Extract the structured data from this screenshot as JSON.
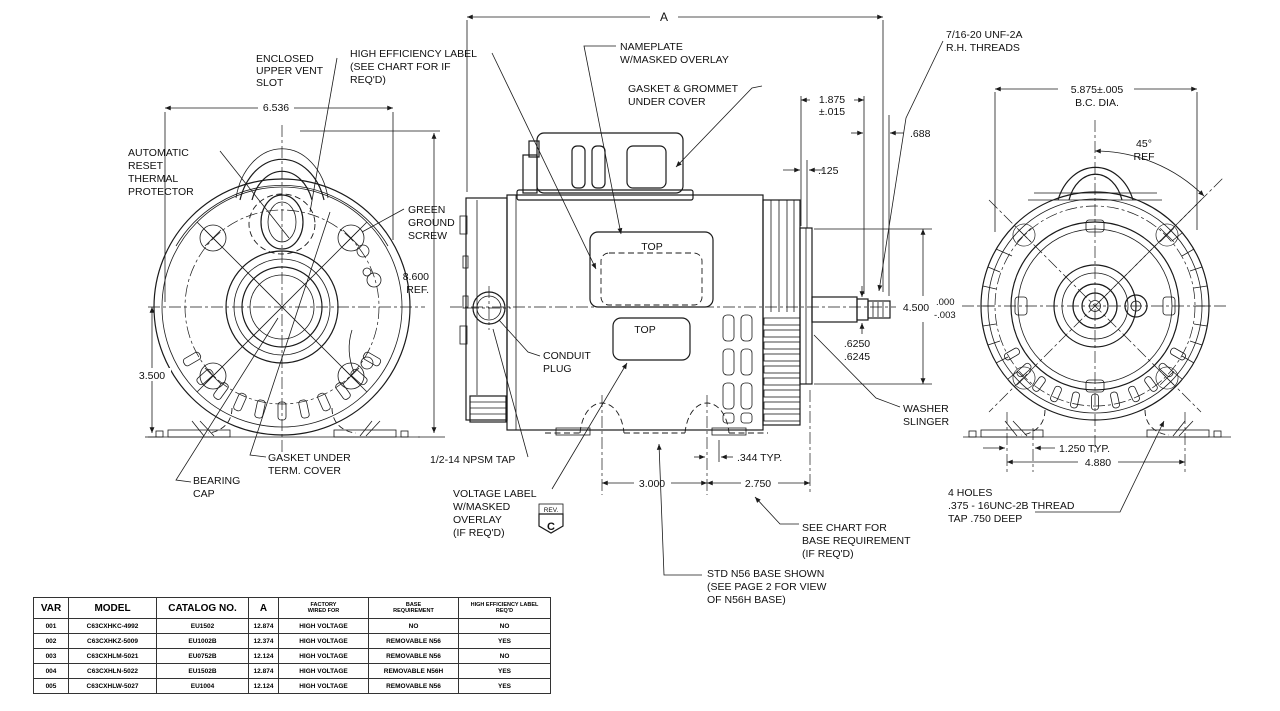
{
  "drawing": {
    "dim_a": "A",
    "d6536": "6.536",
    "d3500": "3.500",
    "d8600": {
      "l1": "8.600",
      "l2": "REF."
    },
    "d1875": {
      "l1": "1.875",
      "l2": "±.015"
    },
    "d688": ".688",
    "d125": ".125",
    "d4500": "4.500",
    "d4500_tol_plus": ".000",
    "d4500_tol_minus": "-.003",
    "shaft_dia": {
      "l1": ".6250",
      "l2": ".6245"
    },
    "d344": ".344 TYP.",
    "d3000": "3.000",
    "d2750": "2.750",
    "d1250": "1.250 TYP.",
    "d4880": "4.880",
    "bc_dia": {
      "l1": "5.875±.005",
      "l2": "B.C. DIA."
    },
    "angle45": {
      "l1": "45°",
      "l2": "REF"
    },
    "labels": {
      "enclosed": {
        "l1": "ENCLOSED",
        "l2": "UPPER VENT",
        "l3": "SLOT"
      },
      "high_eff": {
        "l1": "HIGH EFFICIENCY LABEL",
        "l2": "(SEE CHART FOR IF",
        "l3": "REQ'D)"
      },
      "nameplate": {
        "l1": "NAMEPLATE",
        "l2": "W/MASKED OVERLAY"
      },
      "gasket_grommet": {
        "l1": "GASKET & GROMMET",
        "l2": "UNDER COVER"
      },
      "threads": {
        "l1": "7/16-20 UNF-2A",
        "l2": "R.H. THREADS"
      },
      "auto_reset": {
        "l1": "AUTOMATIC",
        "l2": "RESET",
        "l3": "THERMAL",
        "l4": "PROTECTOR"
      },
      "green_screw": {
        "l1": "GREEN",
        "l2": "GROUND",
        "l3": "SCREW"
      },
      "top_nameplate": "TOP",
      "top_voltage": "TOP",
      "conduit": {
        "l1": "CONDUIT",
        "l2": "PLUG"
      },
      "washer": {
        "l1": "WASHER",
        "l2": "SLINGER"
      },
      "gasket_term": {
        "l1": "GASKET UNDER",
        "l2": "TERM. COVER"
      },
      "bearing": {
        "l1": "BEARING",
        "l2": "CAP"
      },
      "npsm": "1/2-14 NPSM TAP",
      "voltage": {
        "l1": "VOLTAGE LABEL",
        "l2": "W/MASKED",
        "l3": "OVERLAY",
        "l4": "(IF REQ'D)"
      },
      "rev_label": "REV.",
      "rev_letter": "C",
      "see_chart": {
        "l1": "SEE CHART FOR",
        "l2": "BASE REQUIREMENT",
        "l3": "(IF REQ'D)"
      },
      "std_base": {
        "l1": "STD N56 BASE SHOWN",
        "l2": "(SEE PAGE 2 FOR VIEW",
        "l3": "OF N56H BASE)"
      },
      "holes": {
        "l1": "4 HOLES",
        "l2": ".375 - 16UNC-2B THREAD",
        "l3": "TAP .750 DEEP"
      }
    }
  },
  "table": {
    "headers_large": [
      "VAR",
      "MODEL",
      "CATALOG NO.",
      "A"
    ],
    "headers_small": [
      {
        "l1": "FACTORY",
        "l2": "WIRED FOR"
      },
      {
        "l1": "BASE",
        "l2": "REQUIREMENT"
      },
      {
        "l1": "HIGH EFFICIENCY LABEL",
        "l2": "REQ'D"
      }
    ],
    "rows": [
      [
        "001",
        "C63CXHKC-4992",
        "EU1502",
        "12.874",
        "HIGH VOLTAGE",
        "NO",
        "NO"
      ],
      [
        "002",
        "C63CXHKZ-5009",
        "EU1002B",
        "12.374",
        "HIGH VOLTAGE",
        "REMOVABLE N56",
        "YES"
      ],
      [
        "003",
        "C63CXHLM-5021",
        "EU0752B",
        "12.124",
        "HIGH VOLTAGE",
        "REMOVABLE N56",
        "NO"
      ],
      [
        "004",
        "C63CXHLN-5022",
        "EU1502B",
        "12.874",
        "HIGH VOLTAGE",
        "REMOVABLE N56H",
        "YES"
      ],
      [
        "005",
        "C63CXHLW-5027",
        "EU1004",
        "12.124",
        "HIGH VOLTAGE",
        "REMOVABLE N56",
        "YES"
      ]
    ]
  }
}
